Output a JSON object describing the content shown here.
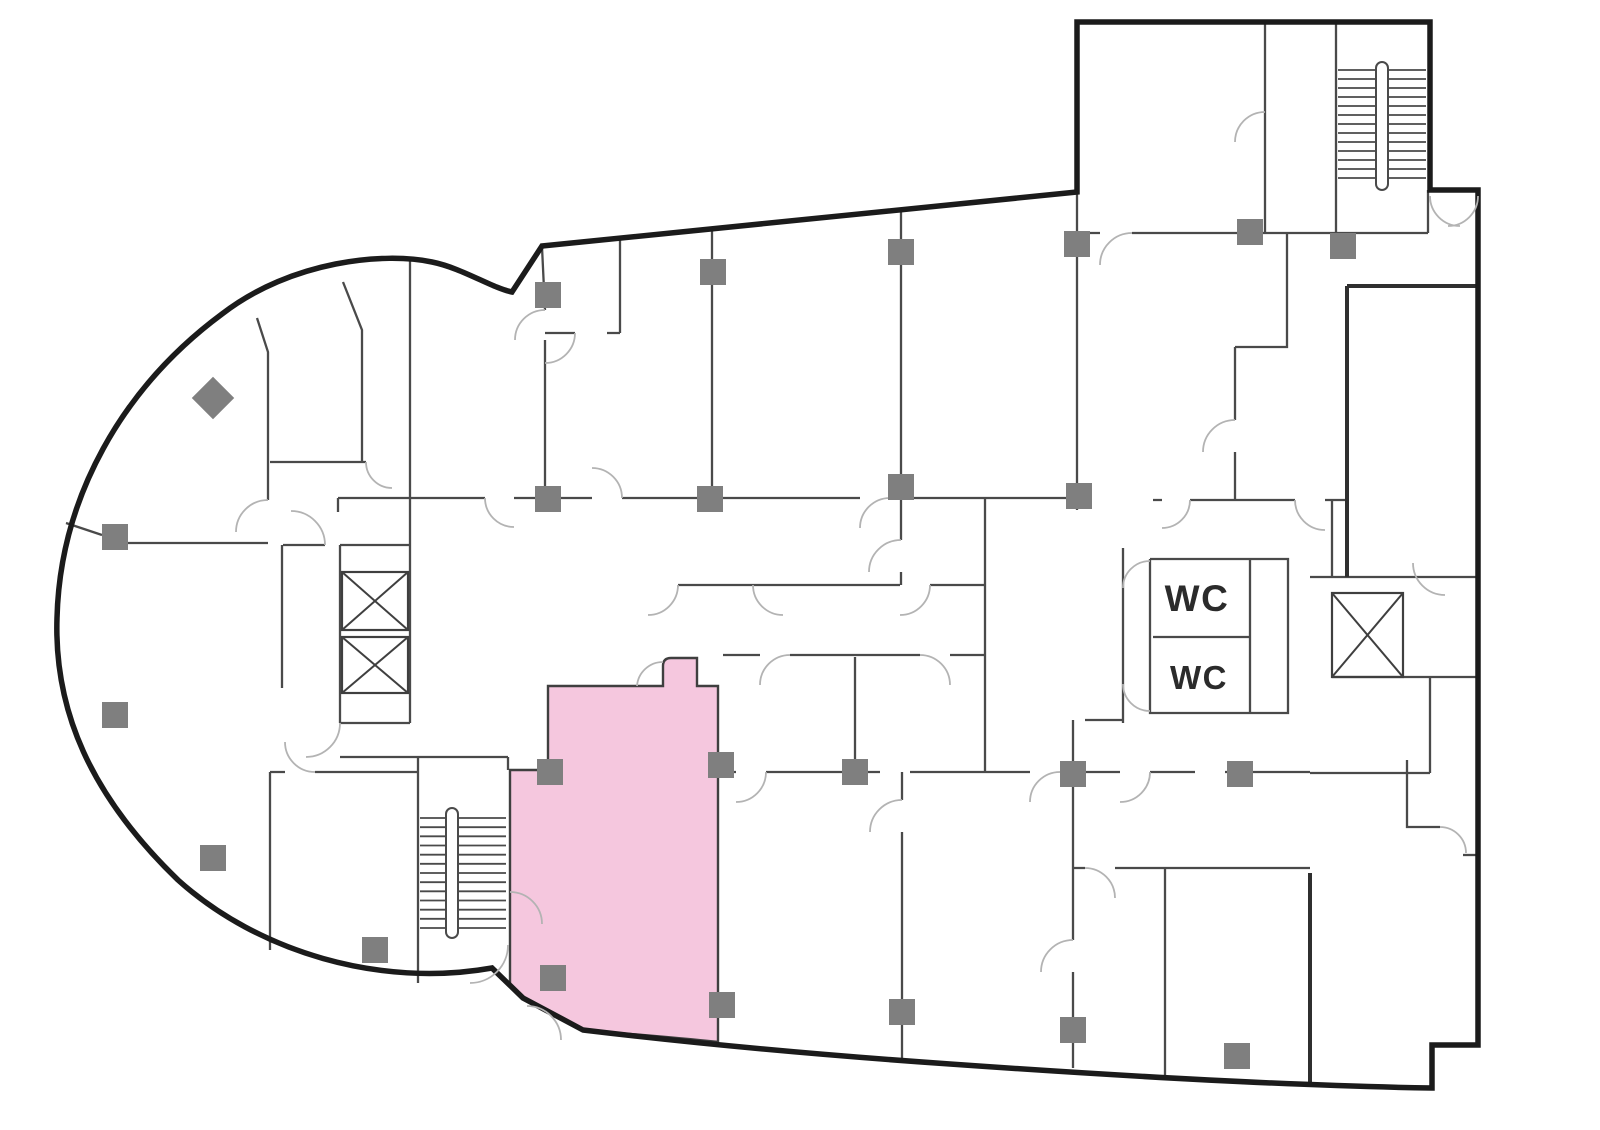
{
  "labels": {
    "wc_upper": "WC",
    "wc_lower": "WC"
  },
  "colors": {
    "background": "#ffffff",
    "outline": "#1b1b1b",
    "wall": "#4a4a4a",
    "thick_wall": "#2f2f2f",
    "door": "#b3b3b3",
    "column": "#7f7f7f",
    "highlight": "#f5c7de",
    "highlight_stroke": "#3f3f3f",
    "stair": "#4a4a4a",
    "elevator": "#3f3f3f",
    "text": "#2b2b2b"
  },
  "geometry": {
    "outline_path": "M1077,192 L1077,22 L1430,22 L1430,190 L1478,190 L1478,1045 L1432,1045 L1432,1088 C1300,1086 1120,1076 950,1064 C820,1055 700,1044 583,1030 L523,998 L492,968 C380,988 258,952 178,880 C90,795 54,710 57,618 C60,498 122,388 222,314 C292,260 385,252 432,262 C462,268 492,288 512,292 L542,246 L1077,192 Z",
    "highlight_room": {
      "path": "M548,686 L663,686 L663,666 Q663,658 671,658 L697,658 L697,686 L718,686 L718,1042 C660,1036 616,1033 583,1030 L523,998 L510,986 L510,770 L548,770 Z"
    },
    "thick_walls": [
      "M1347,286 L1478,286",
      "M1347,286 L1347,577",
      "M1310,873 L1310,1085"
    ],
    "thin_walls": [
      "M257,318 L268,352 L268,500",
      "M282,545 L282,688",
      "M66,523 L102,535",
      "M128,543 L268,543",
      "M283,545 L325,545",
      "M343,282 L362,330 L362,462",
      "M270,462 L366,462",
      "M410,258 L410,545",
      "M338,498 L485,498 M514,498 L592,498 M622,498 L860,498 M890,498 L1092,498",
      "M338,498 L338,512",
      "M542,247 L545,310 M545,340 L545,498",
      "M620,240 L620,333",
      "M545,333 L575,333 M607,333 L620,333",
      "M712,230 L712,498",
      "M901,208 L901,540 M901,572 L901,585",
      "M1077,192 L1077,510",
      "M985,498 L985,772",
      "M678,585 L900,585 M930,585 L985,585",
      "M1265,22 L1265,233",
      "M1336,22 L1336,233",
      "M1077,233 L1100,233 M1132,233 L1428,233",
      "M1428,190 L1428,233",
      "M1287,233 L1287,347 L1235,347",
      "M1235,347 L1235,420 M1235,452 L1235,500",
      "M1153,500 L1162,500 M1190,500 L1295,500 M1325,500 L1347,500",
      "M1332,500 L1332,577",
      "M1310,577 L1478,577",
      "M1332,677 L1478,677",
      "M1123,548 L1123,723",
      "M1150,559 L1288,559 L1288,713 L1150,713 L1150,559",
      "M1250,559 L1250,713",
      "M1153,637 L1250,637",
      "M1085,720 L1123,720",
      "M723,655 L760,655 M790,655 L920,655 M950,655 L985,655",
      "M723,772 L736,772 M766,772 L880,772 M910,772 L1030,772 M1060,772 L1120,772 M1150,772 L1195,772 M1225,772 L1310,772",
      "M1310,773 L1430,773",
      "M855,657 L855,772",
      "M902,772 L902,800 M902,832 L902,1062",
      "M1073,720 L1073,940 M1073,972 L1073,1068",
      "M1073,868 L1085,868 M1115,868 L1310,868",
      "M1165,868 L1165,1078",
      "M1407,760 L1407,827 L1440,827",
      "M1463,855 L1478,855",
      "M1430,677 L1430,773",
      "M270,772 L285,772 M315,772 L418,772",
      "M270,772 L270,950",
      "M340,757 L508,757 M508,757 L508,770",
      "M418,757 L418,983",
      "M340,545 L410,545 M340,545 L340,723 M410,545 L410,723 M340,723 L410,723"
    ],
    "door_arcs": [
      "M575,333 A30,30 0 0 1 545,363",
      "M268,500 A32,32 0 0 0 236,532",
      "M678,585 A30,30 0 0 1 648,615",
      "M753,585 A30,30 0 0 0 783,615",
      "M930,585 A30,30 0 0 1 900,615",
      "M901,540 A32,32 0 0 0 869,572",
      "M622,498 A30,30 0 0 0 592,468",
      "M890,498 A30,30 0 0 0 860,528",
      "M485,498 A29,29 0 0 0 514,527",
      "M366,462 A26,26 0 0 0 392,488",
      "M545,310 A30,30 0 0 0 515,340",
      "M663,662 A26,26 0 0 0 637,686",
      "M510,892 A32,32 0 0 1 542,924",
      "M527,1006 A34,34 0 0 1 561,1040",
      "M508,945 A38,38 0 0 1 470,983",
      "M1150,561 A27,27 0 0 0 1123,588",
      "M1150,711 A27,27 0 0 1 1123,684",
      "M1132,233 A32,32 0 0 0 1100,265",
      "M1265,112 A30,30 0 0 0 1235,142",
      "M1430,196 A30,30 0 0 0 1460,226",
      "M1478,196 A30,30 0 0 1 1448,226",
      "M1235,420 A32,32 0 0 0 1203,452",
      "M1190,500 A28,28 0 0 1 1162,528",
      "M1295,500 A30,30 0 0 0 1325,530",
      "M1445,595 A32,32 0 0 1 1413,563",
      "M1085,868 A30,30 0 0 1 1115,898",
      "M1073,940 A32,32 0 0 0 1041,972",
      "M790,655 A30,30 0 0 0 760,685",
      "M920,655 A30,30 0 0 1 950,685",
      "M902,800 A32,32 0 0 0 870,832",
      "M766,772 A30,30 0 0 1 736,802",
      "M1060,772 A30,30 0 0 0 1030,802",
      "M1150,772 A30,30 0 0 1 1120,802",
      "M315,772 A30,30 0 0 1 285,742",
      "M325,545 A34,34 0 0 0 291,511",
      "M340,723 A34,34 0 0 1 306,757",
      "M1440,827 A26,26 0 0 1 1466,853"
    ],
    "stairs": [
      {
        "x1": 1338,
        "x2": 1426,
        "y_start": 70,
        "y_end": 178,
        "steps": 12,
        "rail": {
          "x": 1376,
          "y": 62,
          "w": 12,
          "h": 128
        }
      },
      {
        "x1": 420,
        "x2": 506,
        "y_start": 818,
        "y_end": 928,
        "steps": 12,
        "rail": {
          "x": 446,
          "y": 808,
          "w": 12,
          "h": 130
        }
      }
    ],
    "elevators": [
      {
        "x": 342,
        "y": 572,
        "w": 66,
        "h": 58
      },
      {
        "x": 342,
        "y": 637,
        "w": 66,
        "h": 56
      },
      {
        "x": 1332,
        "y": 593,
        "w": 71,
        "h": 84
      }
    ],
    "columns": [
      [
        548,
        295
      ],
      [
        713,
        272
      ],
      [
        901,
        252
      ],
      [
        1077,
        244
      ],
      [
        1250,
        232
      ],
      [
        1343,
        246
      ],
      [
        548,
        499
      ],
      [
        710,
        499
      ],
      [
        901,
        487
      ],
      [
        1079,
        496
      ],
      [
        115,
        537
      ],
      [
        115,
        715
      ],
      [
        213,
        858
      ],
      [
        375,
        950
      ],
      [
        550,
        772
      ],
      [
        721,
        765
      ],
      [
        553,
        978
      ],
      [
        722,
        1005
      ],
      [
        855,
        772
      ],
      [
        1073,
        774
      ],
      [
        1240,
        774
      ],
      [
        902,
        1012
      ],
      [
        1073,
        1030
      ],
      [
        1237,
        1056
      ]
    ],
    "column_size": 26,
    "diamond_column": {
      "x": 213,
      "y": 398,
      "size": 30
    },
    "wc_text": {
      "upper": {
        "x": 1197,
        "y": 611
      },
      "lower": {
        "x": 1199,
        "y": 689
      }
    }
  }
}
